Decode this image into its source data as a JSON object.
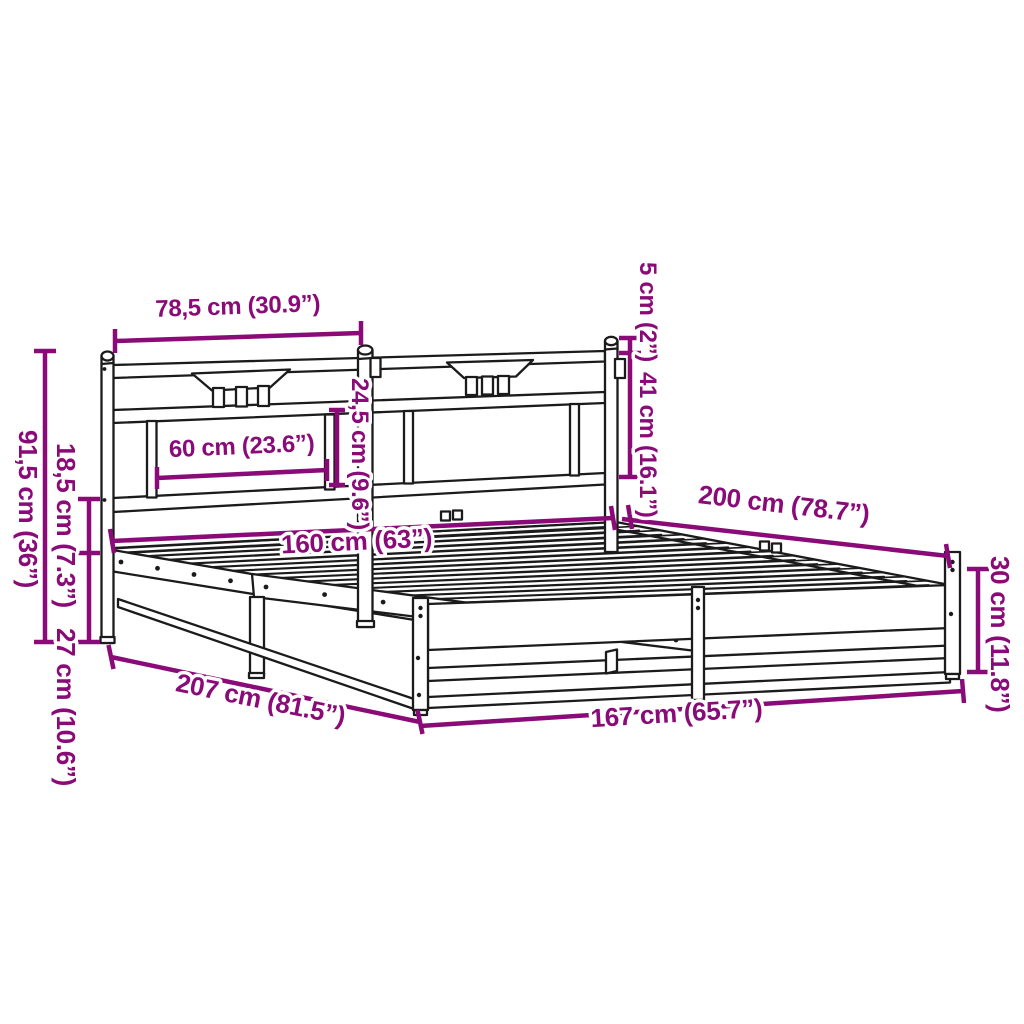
{
  "diagram": {
    "colors": {
      "line": "#1b1b1b",
      "dimension": "#8A0B78",
      "background": "#ffffff"
    },
    "labels": {
      "headboard_section_width": "78,5 cm (30.9”)",
      "post_cap_height": "5 cm (2”)",
      "headboard_rail_to_base": "41 cm (16.1”)",
      "panel_opening_height": "24,5 cm (9.6”)",
      "panel_opening_width": "60 cm (23.6”)",
      "headboard_height": "91,5 cm (36”)",
      "headboard_clearance": "18,5 cm (7.3”)",
      "platform_height": "27 cm (10.6”)",
      "bed_width": "160 cm (63”)",
      "bed_length": "200 cm (78.7”)",
      "side_frame_height": "30 cm (11.8”)",
      "total_length": "207 cm (81.5”)",
      "total_width": "167 cm (65.7”)"
    }
  }
}
